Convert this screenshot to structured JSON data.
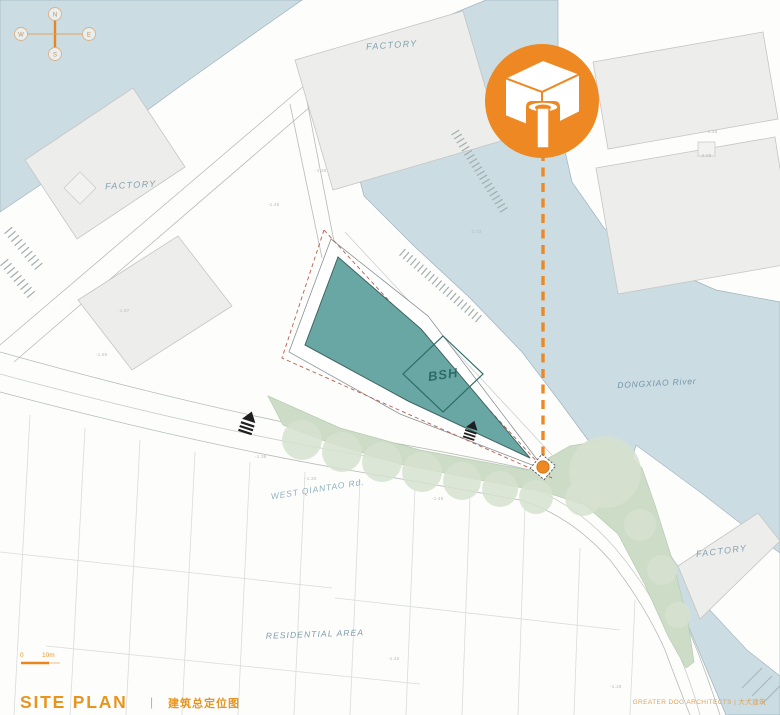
{
  "palette": {
    "orange": "#EE8823",
    "title_orange": "#E8951F",
    "river": "#CBDCE3",
    "teal_site": "#68A7A3",
    "green": "#CCDCC6",
    "tree_green": "#D6E2CF",
    "block_gray": "#EDEDEB",
    "label_blue": "#84A2B2"
  },
  "compass": {
    "n": "N",
    "e": "E",
    "s": "S",
    "w": "W"
  },
  "labels": {
    "factory_top": "FACTORY",
    "factory_left": "FACTORY",
    "factory_bottom_right": "FACTORY",
    "river": "DONGXIAO River",
    "road": "WEST QIANTAO Rd.",
    "residential": "RESIDENTIAL AREA",
    "site": "BSH"
  },
  "scale_bar": {
    "start": "0",
    "end": "10m"
  },
  "title_block": {
    "title": "SITE PLAN",
    "separator": "|",
    "subtitle_cn": "建筑总定位图",
    "credit": "GREATER DOG ARCHITECTS | 大犬建筑"
  },
  "spot_elevations": [
    "-1.35",
    "-1.48",
    "-1.67",
    "-1.50",
    "-1.73",
    "-1.48",
    "-2.08",
    "-1.38",
    "-1.30",
    "-1.45",
    "-1.18",
    "-1.42"
  ]
}
